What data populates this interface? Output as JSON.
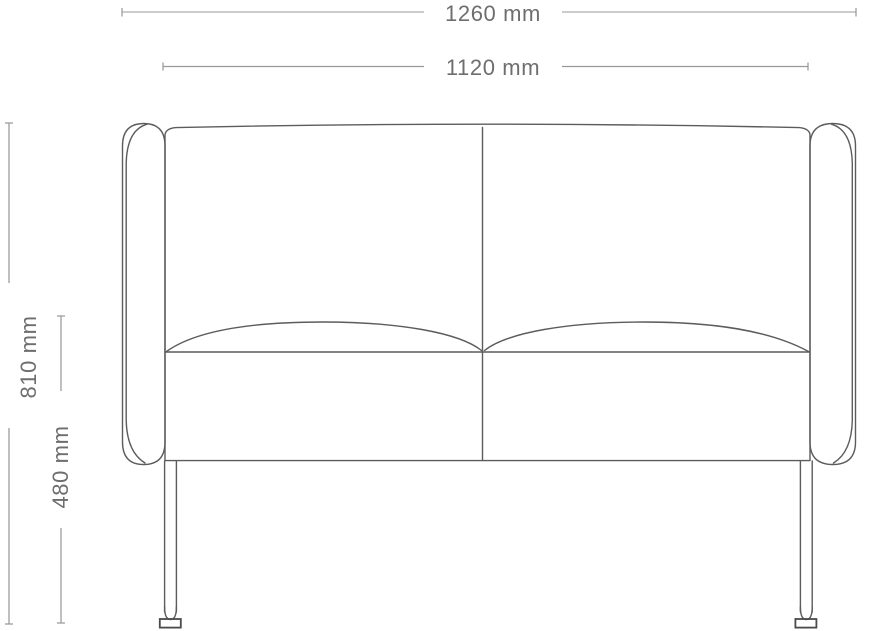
{
  "diagram": {
    "dimensions": {
      "overall_width": {
        "label": "1260 mm",
        "value": 1260,
        "unit": "mm"
      },
      "inner_width": {
        "label": "1120 mm",
        "value": 1120,
        "unit": "mm"
      },
      "overall_height": {
        "label": "810 mm",
        "value": 810,
        "unit": "mm"
      },
      "seat_height": {
        "label": "480 mm",
        "value": 480,
        "unit": "mm"
      }
    }
  },
  "colors": {
    "background": "#ffffff",
    "sofa_outline": "#5c5c5c",
    "foot_outline": "#4a4a4a",
    "dim_line_light": "#cccccc",
    "dim_line": "#999999",
    "dim_text": "#6e6e6e"
  }
}
